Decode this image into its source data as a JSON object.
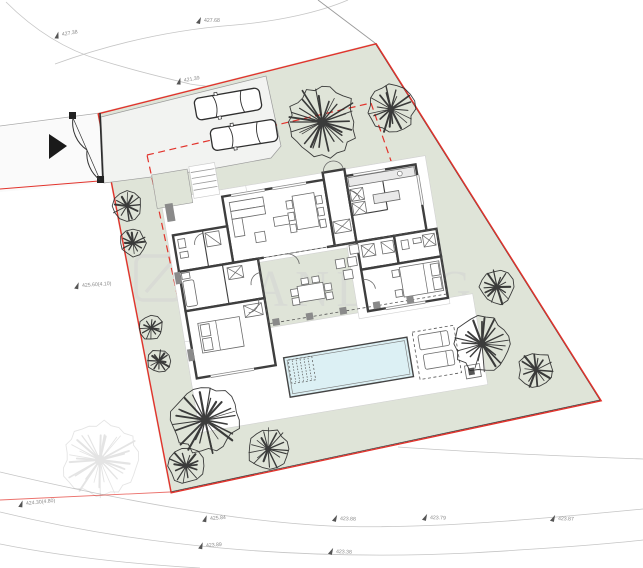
{
  "title": "Villa site plan with pool",
  "watermark": {
    "text": "STANLING"
  },
  "colors": {
    "red": "#e2332c",
    "green": "#dfe4d8",
    "pool": "#dcf0f4",
    "wall": "#3e3e3e",
    "contour": "#c5c5c5",
    "label": "#8a8a8a",
    "wm": "#d4d4d4"
  },
  "elevation_labels": [
    {
      "text": "427.38",
      "x": 62,
      "y": 35,
      "rot": -10
    },
    {
      "text": "427.68",
      "x": 204,
      "y": 21,
      "rot": 0
    },
    {
      "text": "421.39",
      "x": 184,
      "y": 81,
      "rot": -10
    },
    {
      "text": "425.60(4.10)",
      "x": 82,
      "y": 286,
      "rot": -4
    },
    {
      "text": "424.30(4.80)",
      "x": 26,
      "y": 504,
      "rot": -6
    },
    {
      "text": "425.84",
      "x": 210,
      "y": 519,
      "rot": -4
    },
    {
      "text": "423.89",
      "x": 206,
      "y": 546,
      "rot": -4
    },
    {
      "text": "423.88",
      "x": 340,
      "y": 519,
      "rot": 2
    },
    {
      "text": "423.79",
      "x": 430,
      "y": 518,
      "rot": 2
    },
    {
      "text": "423.38",
      "x": 336,
      "y": 552,
      "rot": 2
    },
    {
      "text": "423.87",
      "x": 558,
      "y": 519,
      "rot": 2
    }
  ]
}
